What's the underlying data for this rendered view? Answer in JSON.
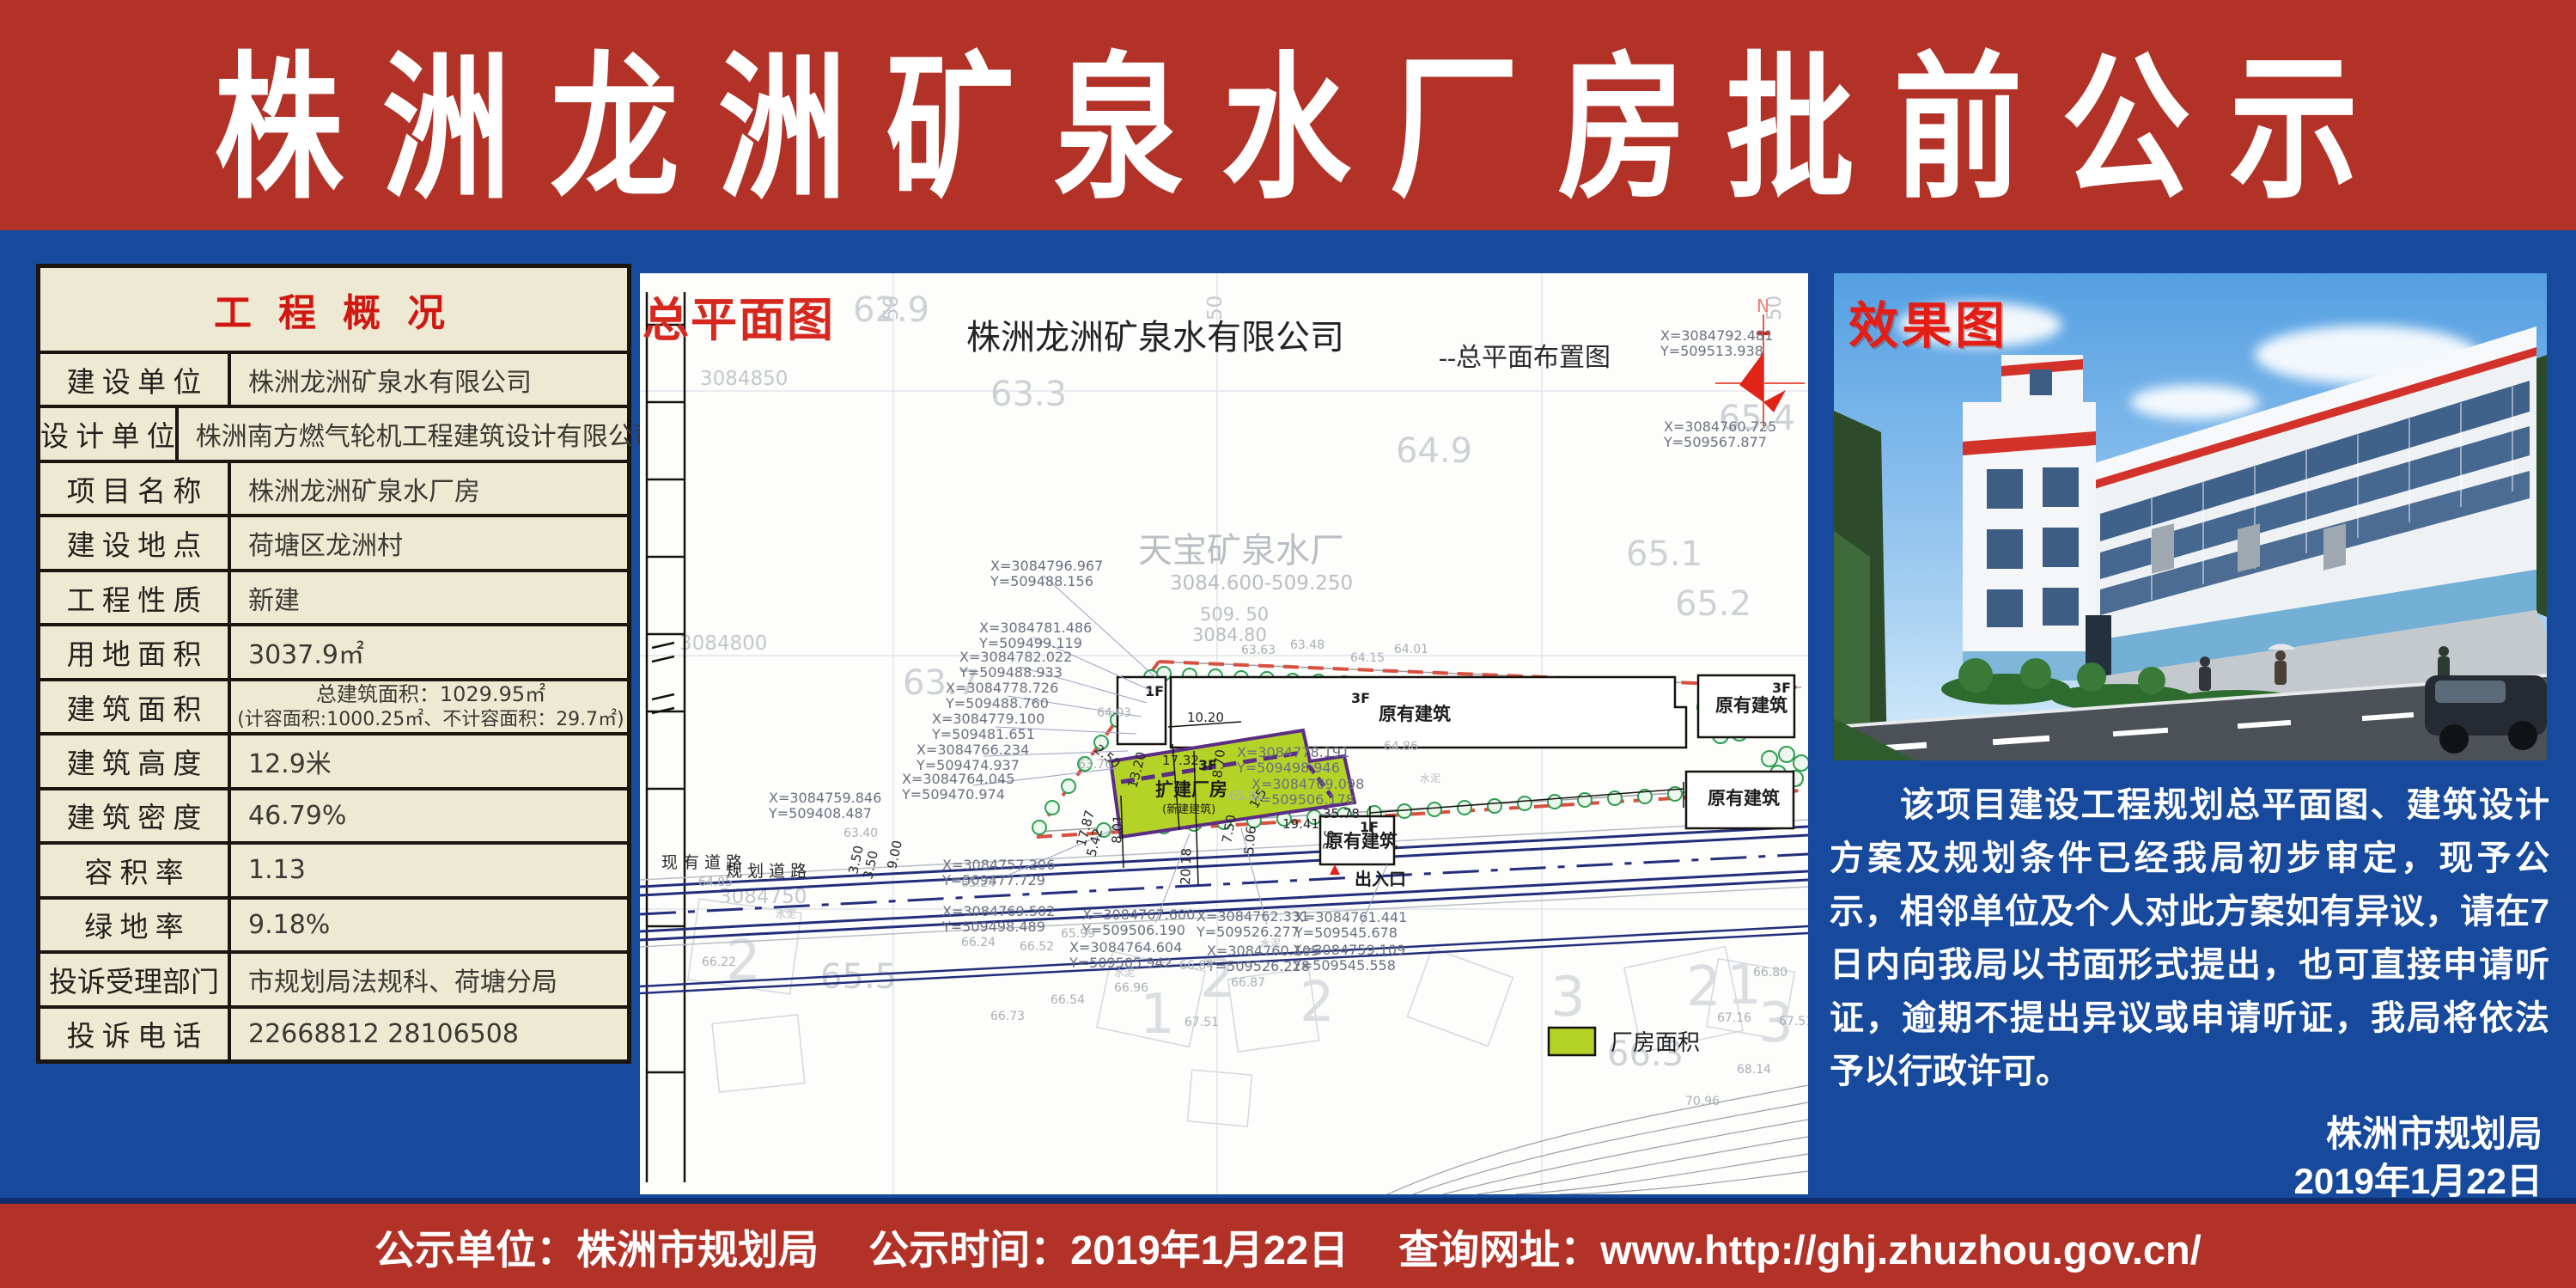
{
  "banner": {
    "title": "株 洲 龙 洲 矿 泉 水 厂 房 批 前 公 示"
  },
  "table": {
    "header": "工 程 概 况",
    "rows": [
      {
        "label": "建 设 单 位",
        "value": "株洲龙洲矿泉水有限公司"
      },
      {
        "label": "设 计 单 位",
        "value": "株洲南方燃气轮机工程建筑设计有限公司"
      },
      {
        "label": "项 目 名 称",
        "value": "株洲龙洲矿泉水厂房"
      },
      {
        "label": "建 设 地 点",
        "value": "荷塘区龙洲村"
      },
      {
        "label": "工 程 性 质",
        "value": "新建"
      },
      {
        "label": "用 地 面 积",
        "value": "3037.9㎡"
      },
      {
        "label": "建 筑 面 积",
        "value": "总建筑面积：1029.95㎡",
        "value2": "(计容面积:1000.25㎡、不计容面积：29.7㎡)"
      },
      {
        "label": "建 筑 高 度",
        "value": "12.9米"
      },
      {
        "label": "建 筑 密 度",
        "value": "46.79%"
      },
      {
        "label": "容 积 率",
        "value": "1.13"
      },
      {
        "label": "绿 地 率",
        "value": "9.18%"
      },
      {
        "label": "投诉受理部门",
        "value": "市规划局法规科、荷塘分局"
      },
      {
        "label": "投 诉 电 话",
        "value": "22668812  28106508"
      }
    ]
  },
  "siteplan": {
    "panel_label": "总平面图",
    "title": "株洲龙洲矿泉水有限公司",
    "subtitle": "--总平面布置图",
    "north": "N",
    "site_name": "天宝矿泉水厂",
    "site_code": "3084.600-509.250",
    "grid_h": [
      "3084850",
      "3084800",
      "3084750"
    ],
    "grid_inline": [
      "509. 50",
      "3084.80"
    ],
    "grid_v": "50",
    "existing_building": "原有建筑",
    "new_building": "扩建厂房",
    "new_building_sub": "(新建建筑)",
    "f3": "3F",
    "f1": "1F",
    "road_existing": "现 有 道 路",
    "road_planned": "规 划 道 路",
    "entrance": "出入口",
    "legend_label": "厂房面积",
    "cement": "水泥",
    "coords": [
      {
        "x": "X=3084796.967",
        "y": "Y=509488.156"
      },
      {
        "x": "X=3084781.486",
        "y": "Y=509499.119"
      },
      {
        "x": "X=3084782.022",
        "y": "Y=509488.933"
      },
      {
        "x": "X=3084778.726",
        "y": "Y=509488.760"
      },
      {
        "x": "X=3084779.100",
        "y": "Y=509481.651"
      },
      {
        "x": "X=3084766.234",
        "y": "Y=509474.937"
      },
      {
        "x": "X=3084764.045",
        "y": "Y=509470.974"
      },
      {
        "x": "X=3084759.846",
        "y": "Y=509408.487"
      },
      {
        "x": "X=3084757.206",
        "y": "Y=509477.729"
      },
      {
        "x": "X=3084769.502",
        "y": "Y=509498.489"
      },
      {
        "x": "X=3084767.600",
        "y": "Y=509506.190"
      },
      {
        "x": "X=3084764.604",
        "y": "Y=509505.942"
      },
      {
        "x": "X=3084762.331",
        "y": "Y=509526.277"
      },
      {
        "x": "X=3084760.105",
        "y": "Y=509526.228"
      },
      {
        "x": "X=3084761.441",
        "y": "Y=509545.678"
      },
      {
        "x": "X=3084759.109",
        "y": "Y=509545.558"
      },
      {
        "x": "X=3084778.191",
        "y": "Y=509498.946"
      },
      {
        "x": "X=3084769.098",
        "y": "Y=509506.178"
      },
      {
        "x": "X=3084792.481",
        "y": "Y=509513.938"
      },
      {
        "x": "X=3084760.725",
        "y": "Y=509567.877"
      }
    ],
    "dims": [
      "10.20",
      "17.32",
      "13.20",
      "8.70",
      "8.01",
      "20.18",
      "19.41",
      "35.78",
      "7.50",
      "5.06",
      "1.5",
      "3.50",
      "3.50",
      "9.00",
      "2.50",
      "17.87",
      "5.42",
      "3.6"
    ],
    "spots": [
      "63.63",
      "63.48",
      "64.01",
      "64.15",
      "64.86",
      "65.03",
      "63.76",
      "64.03",
      "63.40",
      "64.85",
      "66.22",
      "65.24",
      "66.24",
      "66.52",
      "65.99",
      "66.96",
      "66.54",
      "66.73",
      "66.84",
      "66.87",
      "67.51",
      "66.80",
      "67.16",
      "67.51",
      "68.14",
      "70.96"
    ],
    "big_numbers": [
      "62.9",
      "63.3",
      "64.9",
      "65.1",
      "65.2",
      "65.4",
      "63.7",
      "65.5",
      "66.3"
    ],
    "plot_numbers": [
      "2",
      "1",
      "2",
      "2",
      "3",
      "2",
      "1",
      "3"
    ]
  },
  "render": {
    "panel_label": "效果图"
  },
  "notice": {
    "text": "该项目建设工程规划总平面图、建筑设计方案及规划条件已经我局初步审定，现予公示，相邻单位及个人对此方案如有异议，请在7日内向我局以书面形式提出，也可直接申请听证，逾期不提出异议或申请听证，我局将依法予以行政许可。",
    "signer": "株洲市规划局",
    "date": "2019年1月22日"
  },
  "footer": {
    "unit": "公示单位：株洲市规划局",
    "time": "公示时间：2019年1月22日",
    "url": "查询网址：www.http://ghj.zhuzhou.gov.cn/"
  }
}
